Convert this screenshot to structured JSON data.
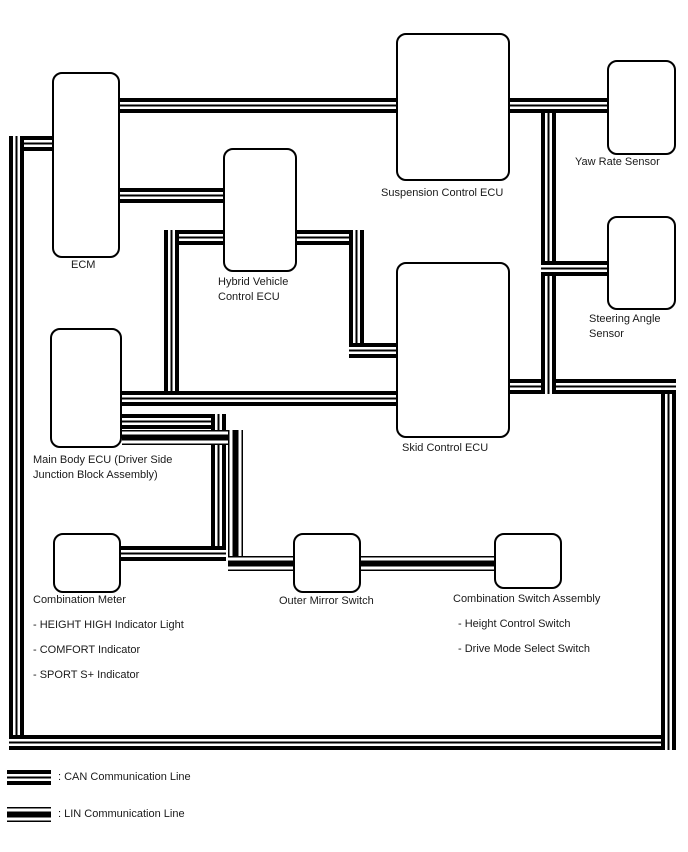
{
  "diagram_title": "Height Control / Drive Mode System Communication Diagram",
  "colors": {
    "line": "#000000",
    "background": "#ffffff",
    "text": "#1a1a1a"
  },
  "nodes": {
    "ecm": {
      "lines": [
        "ECM"
      ]
    },
    "hybrid": {
      "lines": [
        "Hybrid Vehicle",
        "Control ECU"
      ]
    },
    "suspension": {
      "lines": [
        "Suspension Control ECU"
      ]
    },
    "yaw": {
      "lines": [
        "Yaw Rate Sensor"
      ]
    },
    "steering": {
      "lines": [
        "Steering Angle",
        "Sensor"
      ]
    },
    "skid": {
      "lines": [
        "Skid Control ECU"
      ]
    },
    "mainbody": {
      "lines": [
        "Main Body ECU (Driver Side",
        "Junction Block Assembly)"
      ]
    },
    "meter": {
      "lines": [
        "Combination Meter"
      ],
      "bullets": [
        "- HEIGHT HIGH Indicator Light",
        "- COMFORT Indicator",
        "- SPORT S+ Indicator"
      ]
    },
    "mirror": {
      "lines": [
        "Outer Mirror Switch"
      ]
    },
    "combswitch": {
      "lines": [
        "Combination Switch Assembly"
      ],
      "bullets": [
        "- Height Control Switch",
        "- Drive Mode Select Switch"
      ]
    }
  },
  "edges": {
    "can_bus_members": [
      "ECM",
      "Hybrid Vehicle Control ECU",
      "Suspension Control ECU",
      "Yaw Rate Sensor",
      "Steering Angle Sensor",
      "Skid Control ECU",
      "Main Body ECU (Driver Side Junction Block Assembly)",
      "Combination Meter"
    ],
    "lin_bus_members": [
      "Main Body ECU (Driver Side Junction Block Assembly)",
      "Outer Mirror Switch",
      "Combination Switch Assembly"
    ]
  },
  "legend": {
    "can_label": ": CAN Communication Line",
    "lin_label": ": LIN Communication Line"
  }
}
